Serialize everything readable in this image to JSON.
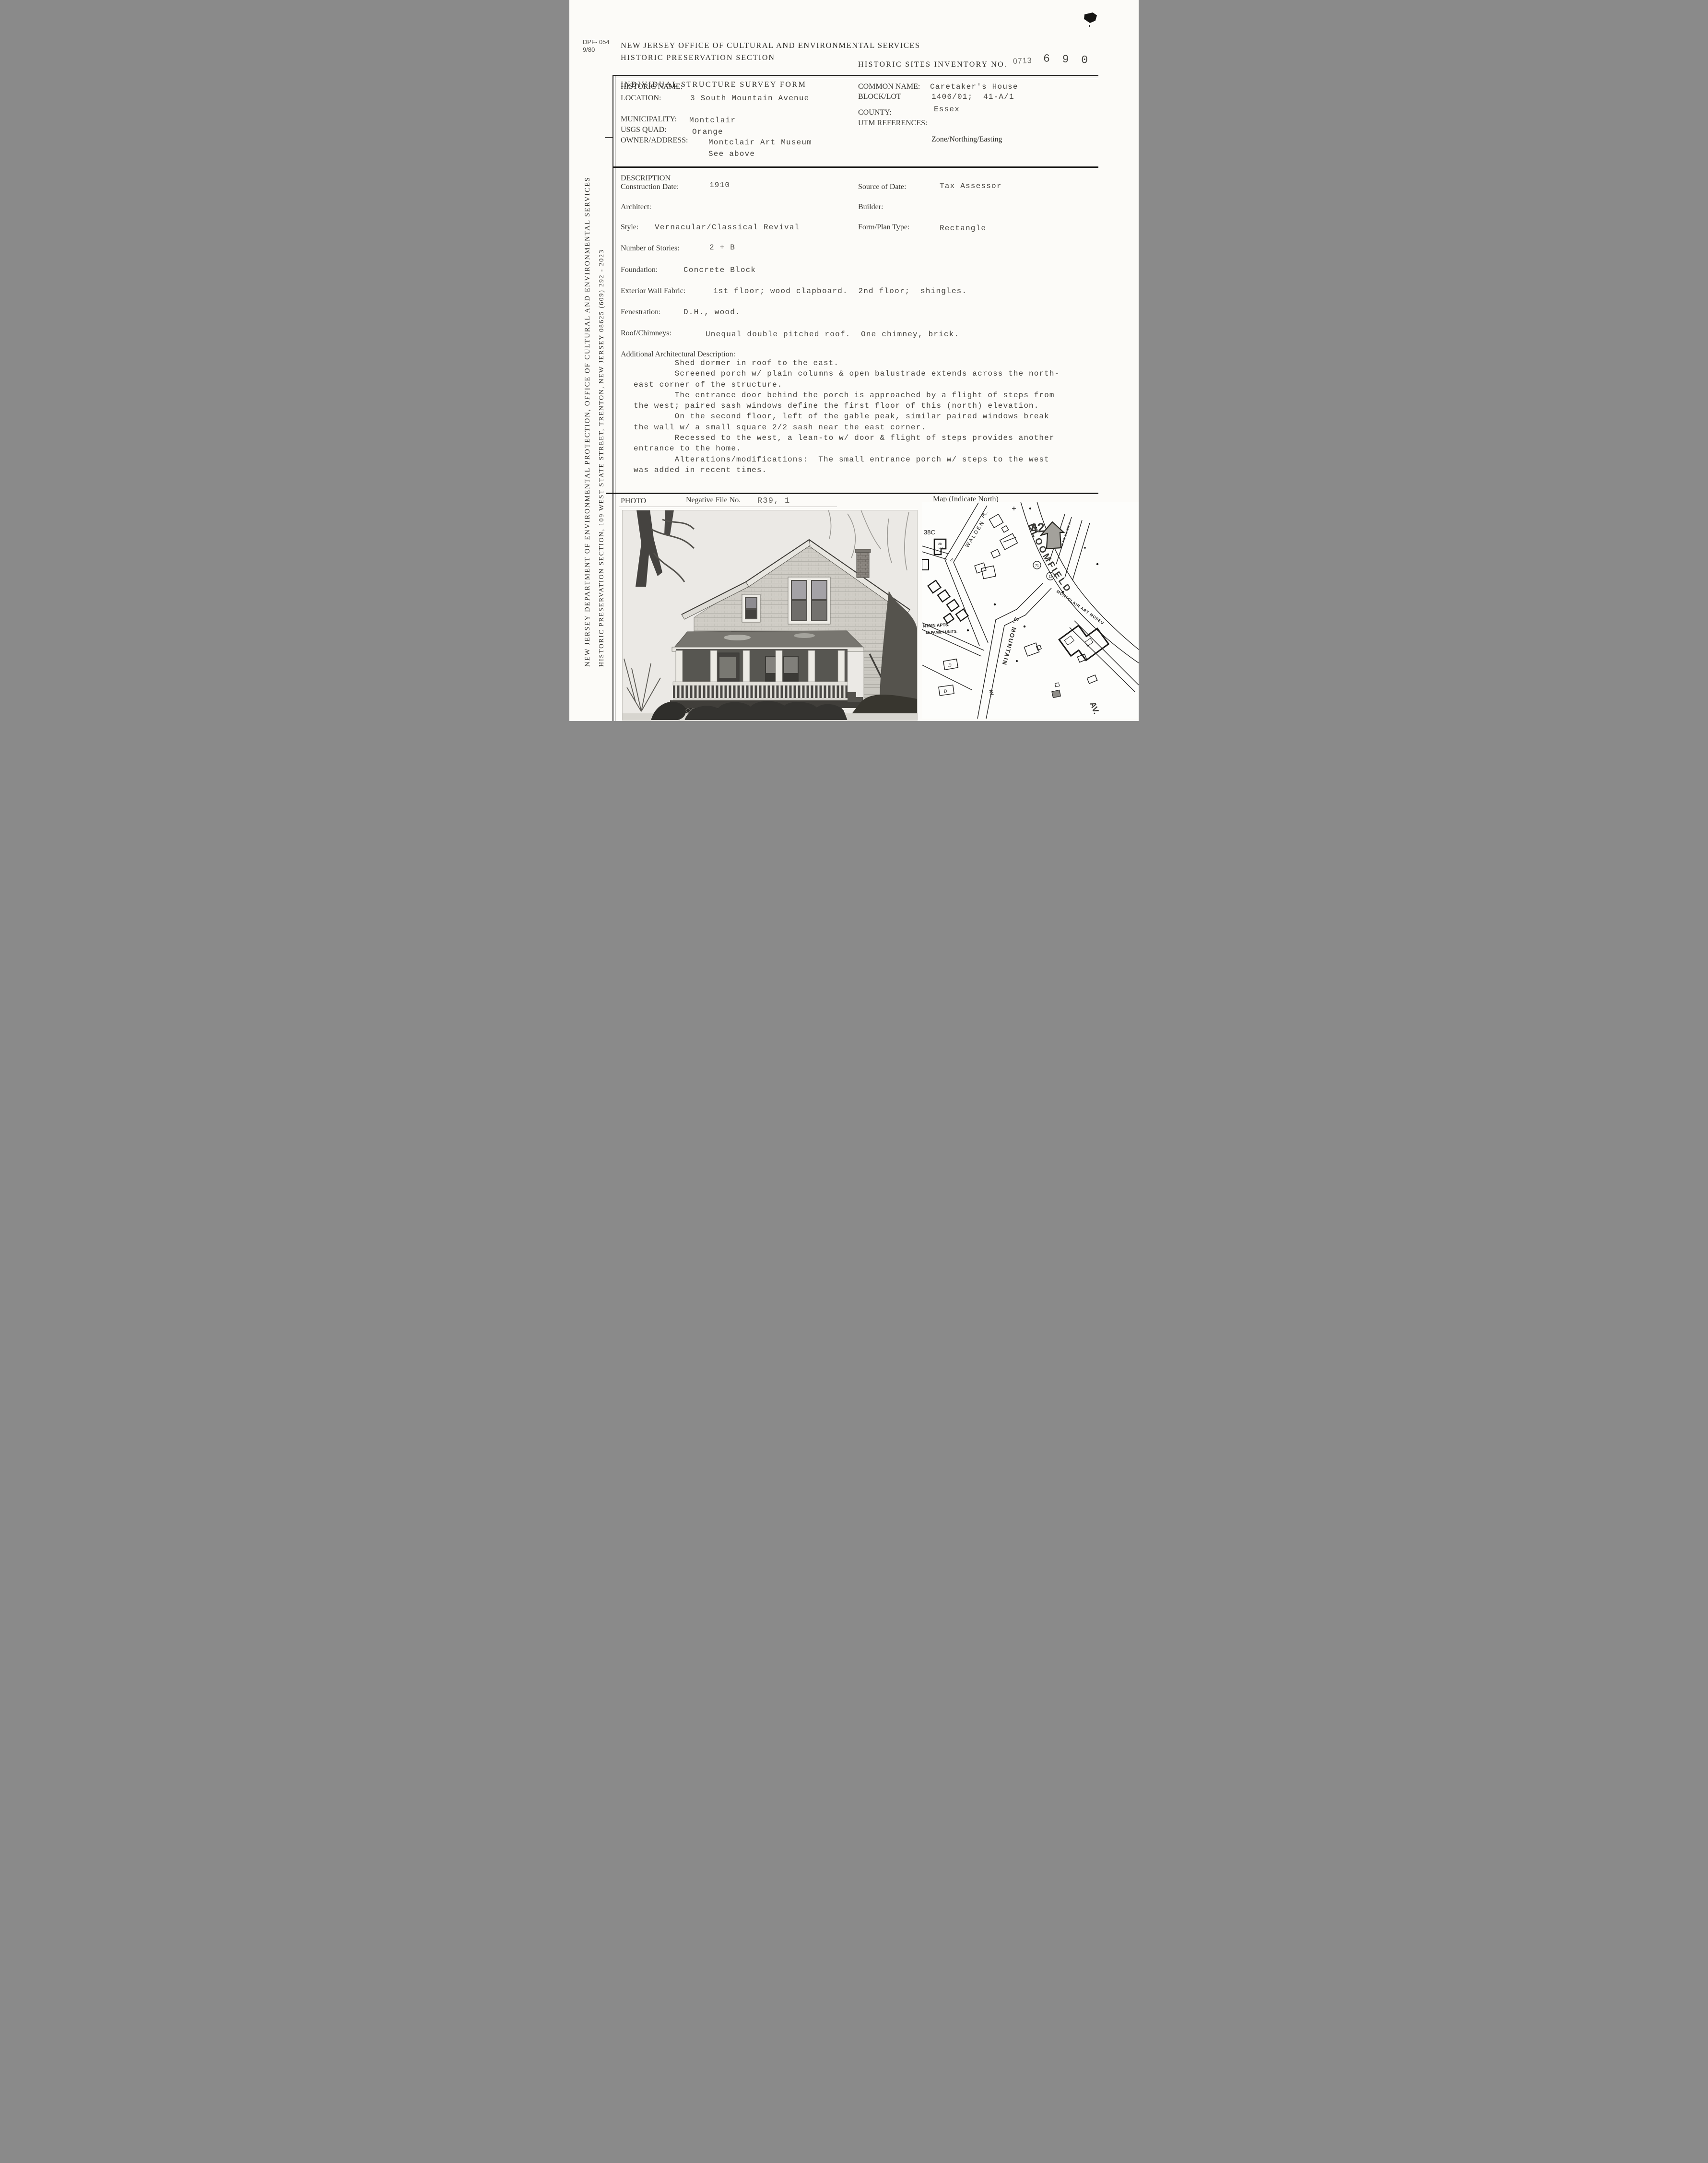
{
  "colors": {
    "paper": "#fcfbf8",
    "ink": "#34332e",
    "typewriter_ink": "#45433e",
    "rule": "#1d1c1a"
  },
  "page": {
    "form_number": "DPF- 054",
    "form_revision": "9/80",
    "agency_line1": "NEW JERSEY OFFICE OF CULTURAL AND ENVIRONMENTAL SERVICES",
    "agency_line2": "HISTORIC PRESERVATION SECTION",
    "form_title": "INDIVIDUAL STRUCTURE SURVEY FORM",
    "inventory_label": "HISTORIC SITES INVENTORY NO.",
    "inventory_prefix": "0713",
    "inventory_number": "6 9 0"
  },
  "sidebar": {
    "line1": "NEW JERSEY DEPARTMENT OF ENVIRONMENTAL PROTECTION, OFFICE OF CULTURAL AND ENVIRONMENTAL SERVICES",
    "line2": "HISTORIC PRESERVATION SECTION, 109 WEST STATE STREET, TRENTON, NEW JERSEY  08625    (609) 292 - 2023"
  },
  "identification": {
    "historic_name_label": "HISTORIC NAME:",
    "location_label": "LOCATION:",
    "location_value": "3 South Mountain Avenue",
    "municipality_label": "MUNICIPALITY:",
    "municipality_value": "Montclair",
    "usgs_quad_label": "USGS QUAD:",
    "usgs_quad_value": "Orange",
    "owner_label": "OWNER/ADDRESS:",
    "owner_value_line1": "Montclair Art Museum",
    "owner_value_line2": "See above",
    "common_name_label": "COMMON NAME:",
    "common_name_value": "Caretaker's House",
    "block_lot_label": "BLOCK/LOT",
    "block_lot_value": "1406/01;  41-A/1",
    "county_label": "COUNTY:",
    "county_value": "Essex",
    "utm_label": "UTM REFERENCES:",
    "utm_sublabel": "Zone/Northing/Easting"
  },
  "description": {
    "section_label": "DESCRIPTION",
    "construction_date_label": "Construction Date:",
    "construction_date_value": "1910",
    "source_of_date_label": "Source of Date:",
    "source_of_date_value": "Tax Assessor",
    "architect_label": "Architect:",
    "builder_label": "Builder:",
    "style_label": "Style:",
    "style_value": "Vernacular/Classical Revival",
    "form_plan_label": "Form/Plan Type:",
    "form_plan_value": "Rectangle",
    "stories_label": "Number of Stories:",
    "stories_value": "2 + B",
    "foundation_label": "Foundation:",
    "foundation_value": "Concrete Block",
    "wall_fabric_label": "Exterior Wall Fabric:",
    "wall_fabric_value": "1st floor; wood clapboard.  2nd floor;  shingles.",
    "fenestration_label": "Fenestration:",
    "fenestration_value": "D.H., wood.",
    "roof_label": "Roof/Chimneys:",
    "roof_value": "Unequal double pitched roof.  One chimney, brick.",
    "additional_label": "Additional Architectural Description:",
    "additional_text": "        Shed dormer in roof to the east.\n        Screened porch w/ plain columns & open balustrade extends across the north-\neast corner of the structure.\n        The entrance door behind the porch is approached by a flight of steps from\nthe west; paired sash windows define the first floor of this (north) elevation.\n        On the second floor, left of the gable peak, similar paired windows break\nthe wall w/ a small square 2/2 sash near the east corner.\n        Recessed to the west, a lean-to w/ door & flight of steps provides another\nentrance to the home.\n        Alterations/modifications:  The small entrance porch w/ steps to the west\nwas added in recent times."
  },
  "photo_section": {
    "photo_label": "PHOTO",
    "negative_file_label": "Negative File No.",
    "negative_file_value": "R39, 1",
    "map_label": "Map  (Indicate North)"
  },
  "map": {
    "corner_ref": "38C",
    "walden": "WALDEN",
    "walden_pl": "PL.",
    "tiny_th": "TH",
    "bloomfield": "BLOOMFIELD",
    "bloomfield_av": "AV.",
    "s_mountain": "S. MOUNTAIN",
    "s_mountain_av": "AV.",
    "n_mountain": "N MOUNTAIN AV",
    "museum": "MONTCLAIR ART MUSEUM",
    "apts_line1": "NTAIN APTS.",
    "apts_line2": "40 FAMILY UNITS.",
    "lot_28": "28",
    "lot_5d": "5-D",
    "d_mark1": "D",
    "d_mark2": "D",
    "handwritten_42": "42",
    "circle_1": "71",
    "circle_2": "12"
  }
}
